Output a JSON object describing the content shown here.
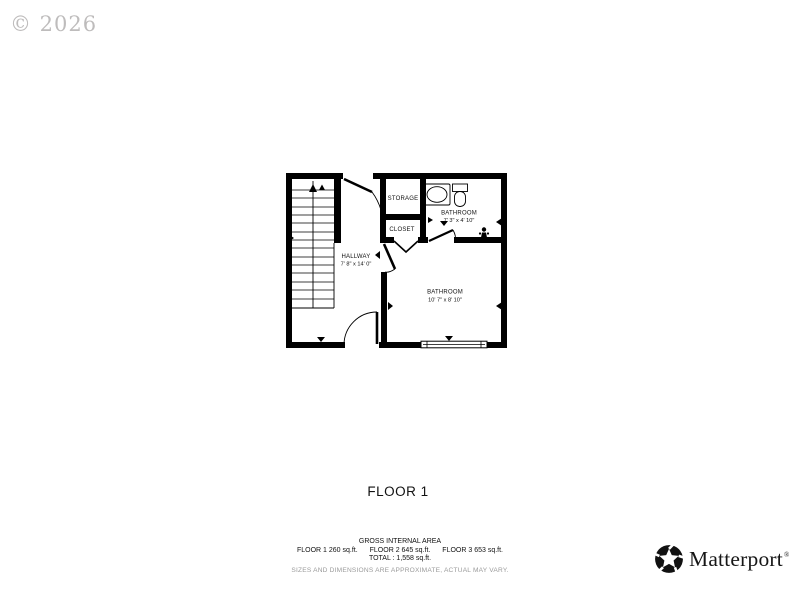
{
  "watermark": {
    "text": "© 2026"
  },
  "floor_label": "FLOOR 1",
  "plan": {
    "rooms": [
      {
        "name": "HALLWAY",
        "dims": "7' 8\" x 14' 0\""
      },
      {
        "name": "STORAGE",
        "dims": ""
      },
      {
        "name": "CLOSET",
        "dims": ""
      },
      {
        "name": "BATHROOM",
        "dims": "7' 3\" x 4' 10\""
      },
      {
        "name": "BATHROOM",
        "dims": "10' 7\" x 8' 10\""
      }
    ],
    "icons": [
      "staircase-up-arrow-icon",
      "sink-vanity-icon",
      "toilet-icon",
      "faucet-icon",
      "door-swing-icon",
      "bifold-door-icon",
      "window-icon",
      "dimension-marker-icon"
    ]
  },
  "footer": {
    "gross_title": "GROSS INTERNAL AREA",
    "floors": [
      "FLOOR 1 260 sq.ft.",
      "FLOOR 2 645 sq.ft.",
      "FLOOR 3 653 sq.ft."
    ],
    "total_line": "TOTAL :  1,558 sq.ft.",
    "disclaimer": "SIZES AND DIMENSIONS ARE APPROXIMATE, ACTUAL MAY VARY."
  },
  "brand": {
    "name": "Matterport",
    "registered_mark": "®"
  },
  "colors": {
    "walls": "#000000",
    "text": "#111111",
    "watermark": "#b3b1b1",
    "disclaimer": "#9b9b9b"
  }
}
